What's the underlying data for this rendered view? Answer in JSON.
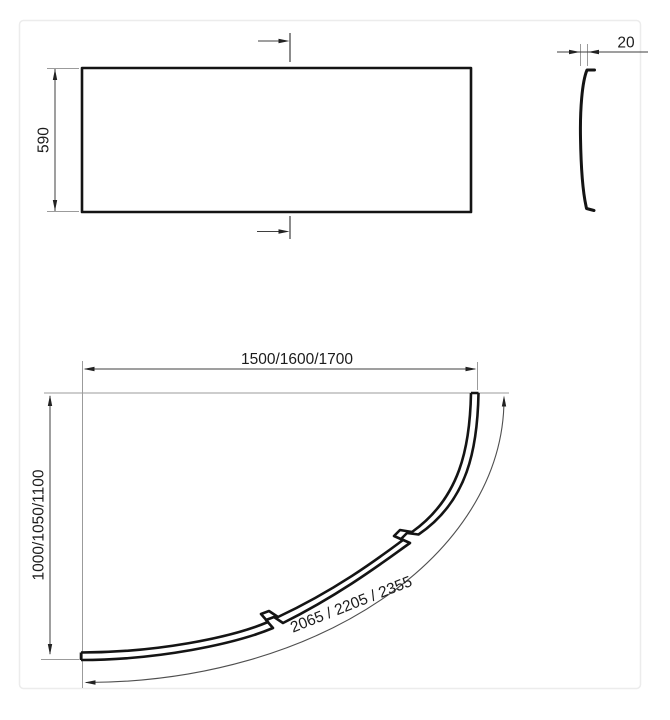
{
  "views": {
    "front": {
      "height": "590"
    },
    "side": {
      "thickness": "20"
    },
    "plan": {
      "width": "1500/1600/1700",
      "depth": "1000/1050/1100",
      "arc_length": "2065 / 2205 / 2355"
    }
  },
  "colors": {
    "background": "#ffffff",
    "object_line": "#141414",
    "dimension_line": "#3f3f3f",
    "extension_line": "#9b9b9b",
    "arc_dimension_line": "#4f4f4f",
    "text": "#1c1c1c",
    "frame": "#ececec"
  }
}
